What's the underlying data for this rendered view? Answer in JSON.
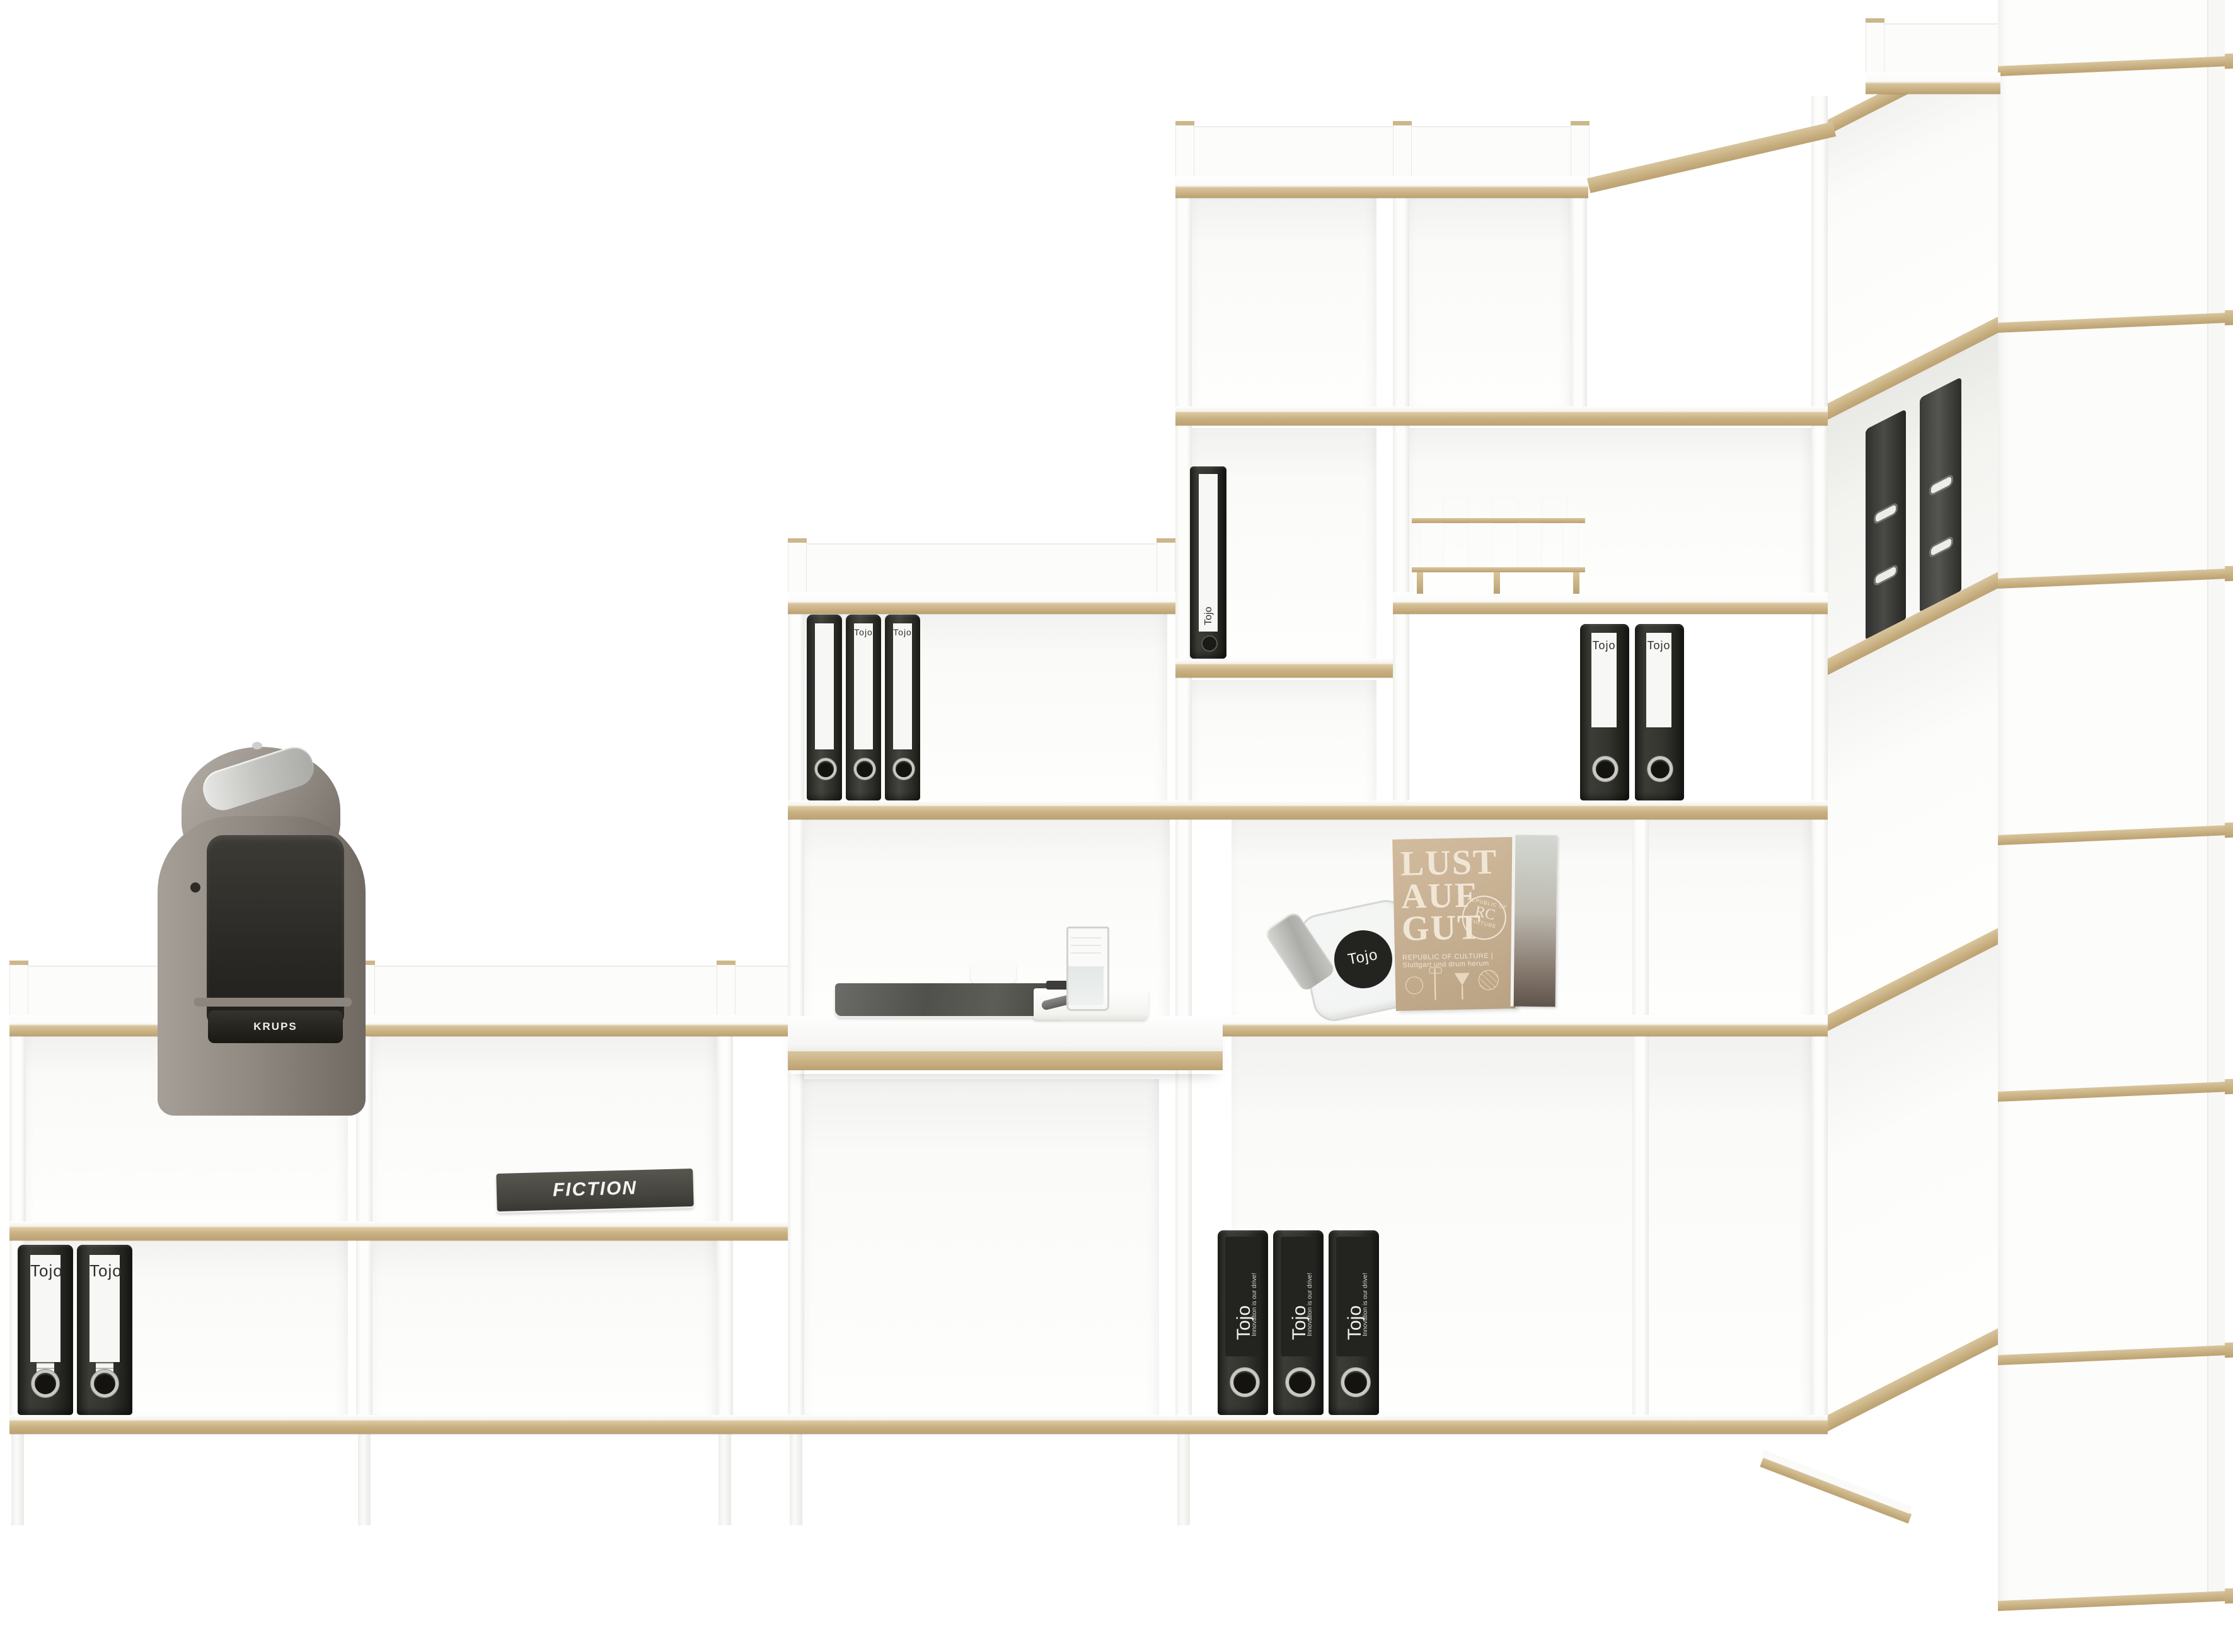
{
  "photo": {
    "type": "product-photo",
    "subject": "white modular corner shelving unit with plywood edges",
    "background": "#ffffff"
  },
  "colors": {
    "wood_edge": "#c9b183",
    "panel_white": "#fdfdfc",
    "binder_black": "#2c2c28",
    "magazine_cover_beige": "#c9b295",
    "machine_titanium": "#9a948c"
  },
  "brand": {
    "name": "Tojo",
    "tm": "™",
    "slogan": "Innovation is our drive!"
  },
  "items": {
    "coffee_machine": {
      "brand": "KRUPS"
    },
    "fiction_magazine": {
      "title": "FICTION"
    },
    "lust_magazine": {
      "line1": "LUST",
      "line2": "AUF",
      "line3": "GUT",
      "seal_initials": "RC",
      "seal_text_top": "REPUBLIC OF",
      "seal_text_bottom": "CULTURE",
      "caption": "REPUBLIC OF CULTURE | Stuttgart und drum herum"
    },
    "jar": {
      "label": "Tojo"
    },
    "binders": {
      "label": "Tojo",
      "labeled_count": 11,
      "dark_count": 2
    }
  }
}
